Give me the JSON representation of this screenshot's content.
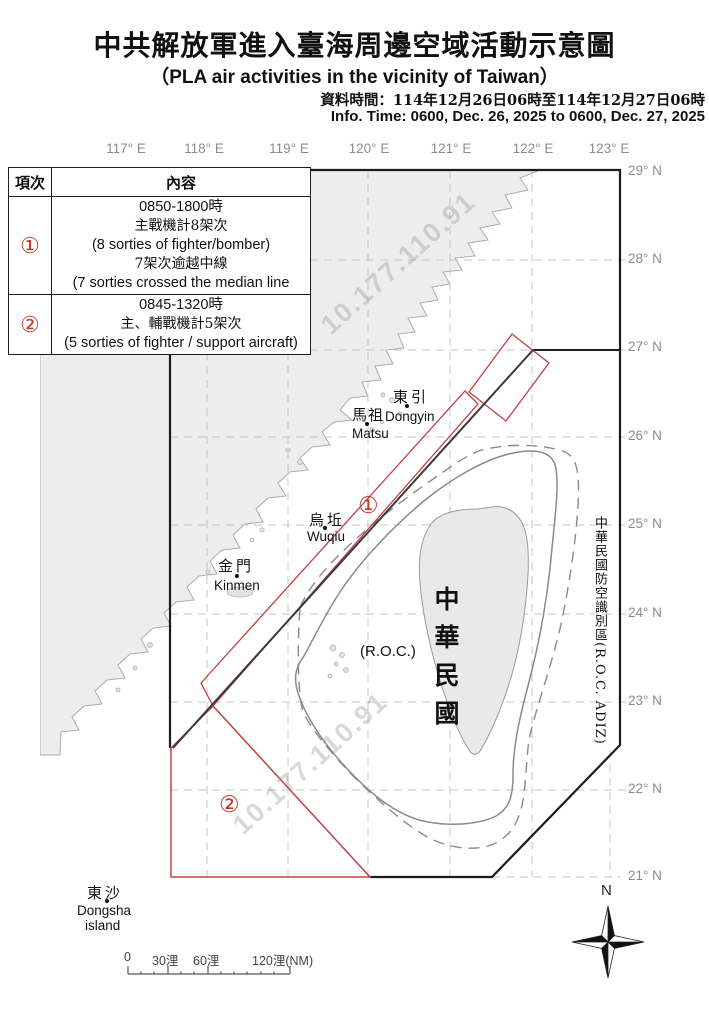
{
  "header": {
    "title_zh": "中共解放軍進入臺海周邊空域活動示意圖",
    "title_en": "（PLA air activities in the vicinity of Taiwan）",
    "info_time_zh": "資料時間：114年12月26日06時至114年12月27日06時",
    "info_time_en": "Info. Time: 0600, Dec. 26, 2025 to 0600, Dec. 27, 2025"
  },
  "table": {
    "headers": [
      "項次",
      "內容"
    ],
    "rows": [
      {
        "num": "①",
        "lines": [
          "0850-1800時",
          "主戰機計8架次",
          "(8 sorties of fighter/bomber)",
          "7架次逾越中線",
          "(7 sorties crossed the median line"
        ]
      },
      {
        "num": "②",
        "lines": [
          "0845-1320時",
          "主、輔戰機計5架次",
          "(5 sorties of fighter / support aircraft)"
        ]
      }
    ]
  },
  "map": {
    "lon_labels": [
      "117° E",
      "118° E",
      "119° E",
      "120° E",
      "121° E",
      "122° E",
      "123° E"
    ],
    "lat_labels": [
      "29° N",
      "28° N",
      "27° N",
      "26° N",
      "25° N",
      "24° N",
      "23° N",
      "22° N",
      "21° N"
    ],
    "places": {
      "dongyin": {
        "zh": "東引",
        "en": "Dongyin"
      },
      "matsu": {
        "zh": "馬祖",
        "en": "Matsu"
      },
      "wuqiu": {
        "zh": "烏坵",
        "en": "Wuqiu"
      },
      "kinmen": {
        "zh": "金門",
        "en": "Kinmen"
      },
      "dongsha": {
        "zh": "東沙",
        "en": "Dongsha",
        "en2": "island"
      },
      "roc": {
        "zh": "中華民國",
        "en": "(R.O.C.)"
      }
    },
    "adiz_label": "中華民國防空識別區(R.O.C. ADIZ)",
    "zone_markers": [
      "①",
      "②"
    ],
    "watermark": "10.177.110.91",
    "compass": "N",
    "scale_ticks": [
      "0",
      "30浬",
      "60浬",
      "120浬(NM)"
    ]
  },
  "colors": {
    "accent_red": "#c0392b",
    "land_gray": "#ededed",
    "contour_gray": "#8a8a8a",
    "frame_black": "#1c1c1c"
  }
}
